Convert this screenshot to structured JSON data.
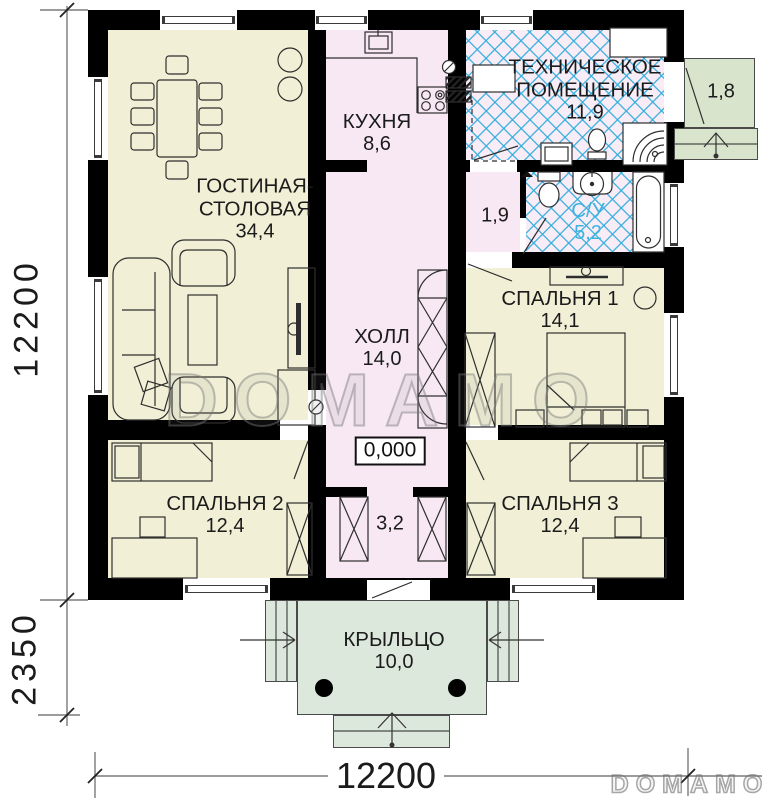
{
  "rooms": {
    "living": {
      "name_line1": "ГОСТИНАЯ-",
      "name_line2": "СТОЛОВАЯ",
      "area": "34,4"
    },
    "kitchen": {
      "name": "КУХНЯ",
      "area": "8,6"
    },
    "tech": {
      "name_line1": "ТЕХНИЧЕСКОЕ",
      "name_line2": "ПОМЕЩЕНИЕ",
      "area": "11,9"
    },
    "vestibule": {
      "area": "1,9"
    },
    "bathroom": {
      "name": "С/У",
      "area": "5,2"
    },
    "bedroom1": {
      "name": "СПАЛЬНЯ 1",
      "area": "14,1"
    },
    "hall": {
      "name": "ХОЛЛ",
      "area": "14,0"
    },
    "bedroom2": {
      "name": "СПАЛЬНЯ 2",
      "area": "12,4"
    },
    "tambour": {
      "area": "3,2"
    },
    "bedroom3": {
      "name": "СПАЛЬНЯ 3",
      "area": "12,4"
    },
    "porch": {
      "name": "КРЫЛЬЦО",
      "area": "10,0"
    },
    "side_porch": {
      "area": "1,8"
    }
  },
  "dimensions": {
    "left_total": "12200",
    "left_porch": "2350",
    "bottom_total": "12200"
  },
  "elevation_mark": "0,000",
  "watermark": "DOMAMO",
  "logo": "DOMAMO",
  "colors": {
    "wall": "#000000",
    "room_yellow": "#f1f0d6",
    "room_pink": "#f7e8f3",
    "hatch_blue": "#3fb3e0",
    "porch_green": "#dde8dd",
    "side_porch_green": "#d8e5cc"
  }
}
